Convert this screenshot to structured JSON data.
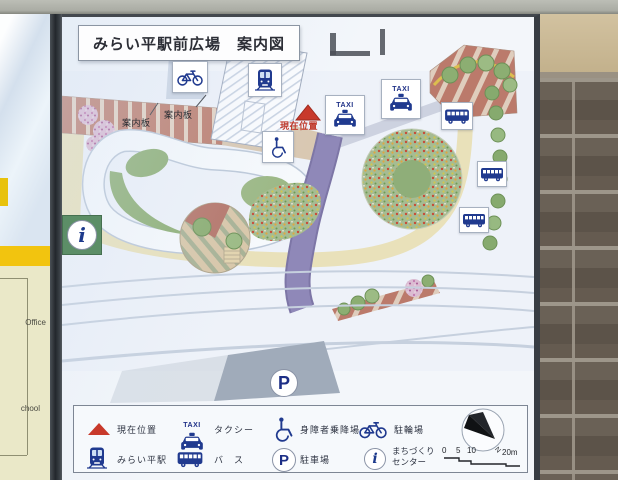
{
  "board": {
    "title": "みらい平駅前広場　案内図"
  },
  "map": {
    "taxi_sign": "TAXI",
    "current_location": "現在位置",
    "guide_boards": [
      "案内板",
      "案内板"
    ]
  },
  "legend": {
    "items": [
      {
        "icon": "current-location-triangle-icon",
        "label": "現在位置"
      },
      {
        "icon": "taxi-icon",
        "label": "タクシー"
      },
      {
        "icon": "wheelchair-icon",
        "label": "身障者乗降場"
      },
      {
        "icon": "bicycle-icon",
        "label": "駐輪場"
      },
      {
        "icon": "train-icon",
        "label": "みらい平駅"
      },
      {
        "icon": "bus-icon",
        "label": "バ　ス"
      },
      {
        "icon": "parking-icon",
        "label": "駐車場"
      },
      {
        "icon": "info-icon",
        "label": "まちづくりセンター"
      }
    ],
    "compass_label": "N",
    "scale_labels": [
      "0",
      "5",
      "10",
      "20m"
    ]
  },
  "neighbor_sign": {
    "texts": [
      "Office",
      "chool"
    ]
  },
  "colors": {
    "icon_blue": "#203a8f",
    "marker_red": "#c6392b",
    "road_khaki": "#e9e1ba",
    "path_purple": "#8f88b8",
    "tree_green": "#8cae72",
    "brick_paving": "#bb7a6b",
    "neighbor_cream": "#eae8c8",
    "neighbor_yellow": "#f2c40f"
  }
}
